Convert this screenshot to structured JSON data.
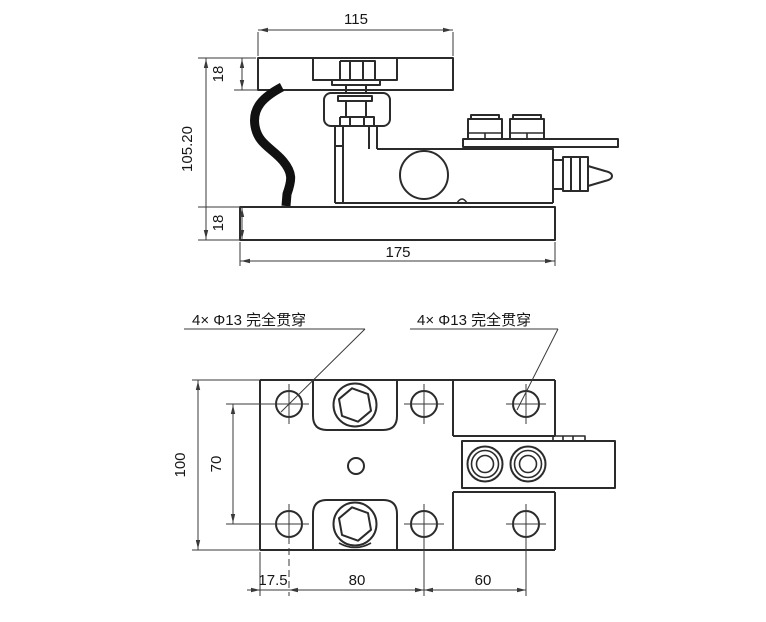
{
  "drawing": {
    "type": "engineering-drawing",
    "background": "#ffffff",
    "line_color": "#2b2b2b",
    "cable_color": "#111111",
    "side_view": {
      "dim_top_plate_width": "115",
      "dim_top_plate_thickness": "18",
      "dim_overall_height": "105.20",
      "dim_bottom_plate_thickness": "18",
      "dim_bottom_plate_width": "175"
    },
    "plan_view": {
      "callout_left": "4× Φ13 完全贯穿",
      "callout_right": "4× Φ13 完全贯穿",
      "dim_plate_depth": "100",
      "dim_hole_spacing_vertical": "70",
      "dim_edge_to_hole": "17.5",
      "dim_hole_spacing_horizontal": "80",
      "dim_hole_spacing_right": "60"
    }
  }
}
